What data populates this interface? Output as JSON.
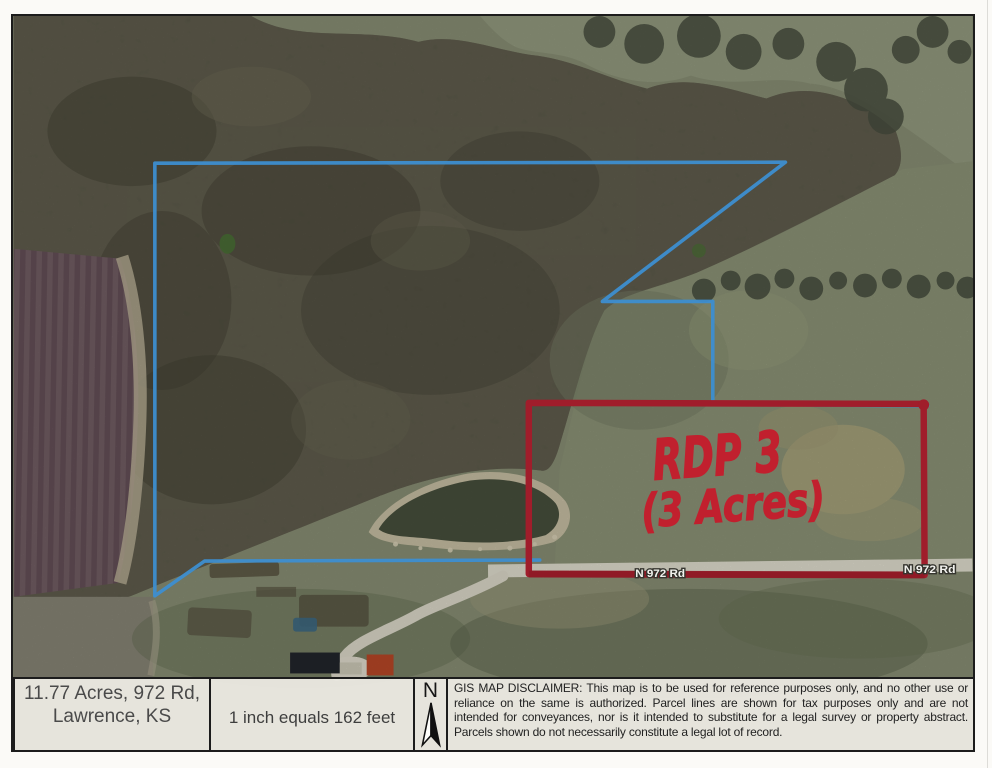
{
  "map": {
    "handwriting": {
      "line1": "RDP 3",
      "line2": "(3 Acres)",
      "color": "#c1202e"
    },
    "road_label_left": "N 972 Rd",
    "road_label_right": "N 972 Rd",
    "parcel_line_color": "#3d8ed0",
    "highlight_box_color": "#a01d2b"
  },
  "info_bar": {
    "address_line1": "11.77 Acres, 972 Rd,",
    "address_line2": "Lawrence, KS",
    "scale_text": "1 inch equals 162 feet",
    "north_label": "N",
    "disclaimer": "GIS MAP DISCLAIMER: This map is to be used for reference purposes only, and no other use or reliance on the same is authorized. Parcel lines are shown for tax purposes only and are not intended for conveyances, nor is it intended to substitute for a legal survey or property abstract. Parcels shown do not necessarily constitute a legal lot of record.",
    "date_printed": "Date Printed: 9/12/2024 11:45 PM",
    "application": "Douglas County KS GIS Web Application"
  }
}
